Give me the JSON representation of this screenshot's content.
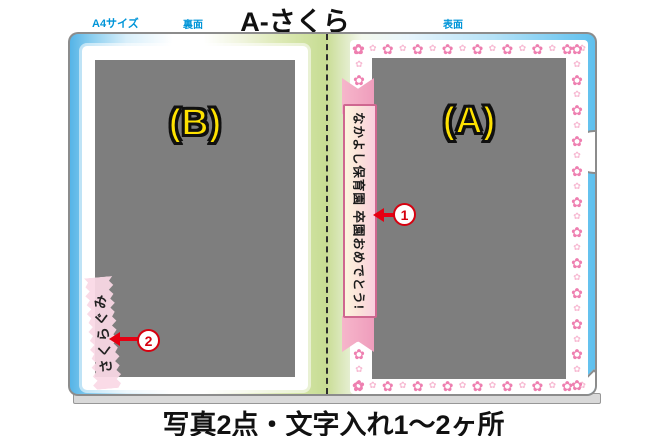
{
  "header": {
    "size_label": "A4サイズ",
    "back_label": "裏面",
    "front_label": "表面",
    "title": "A-さくら"
  },
  "panels": {
    "b": {
      "label": "(B)"
    },
    "a": {
      "label": "(A)"
    }
  },
  "ribbon": {
    "text": "なかよし保育園 卒園おめでとう!"
  },
  "tape": {
    "text": "さくらぐみ"
  },
  "markers": {
    "m1": "1",
    "m2": "2"
  },
  "decor": {
    "flower_glyph": "✿",
    "flower_counts": {
      "top": 16,
      "bottom": 16,
      "left": 23,
      "right": 23
    },
    "colors": {
      "flower_dark": "#ee7fb0",
      "flower_light": "#f7b9d2",
      "accent_red": "#e60012",
      "label_yellow": "#ffe200",
      "header_blue": "#0095d8",
      "photo_gray": "#7e7e7e"
    }
  },
  "footer": {
    "caption": "写真2点・文字入れ1〜2ヶ所"
  }
}
